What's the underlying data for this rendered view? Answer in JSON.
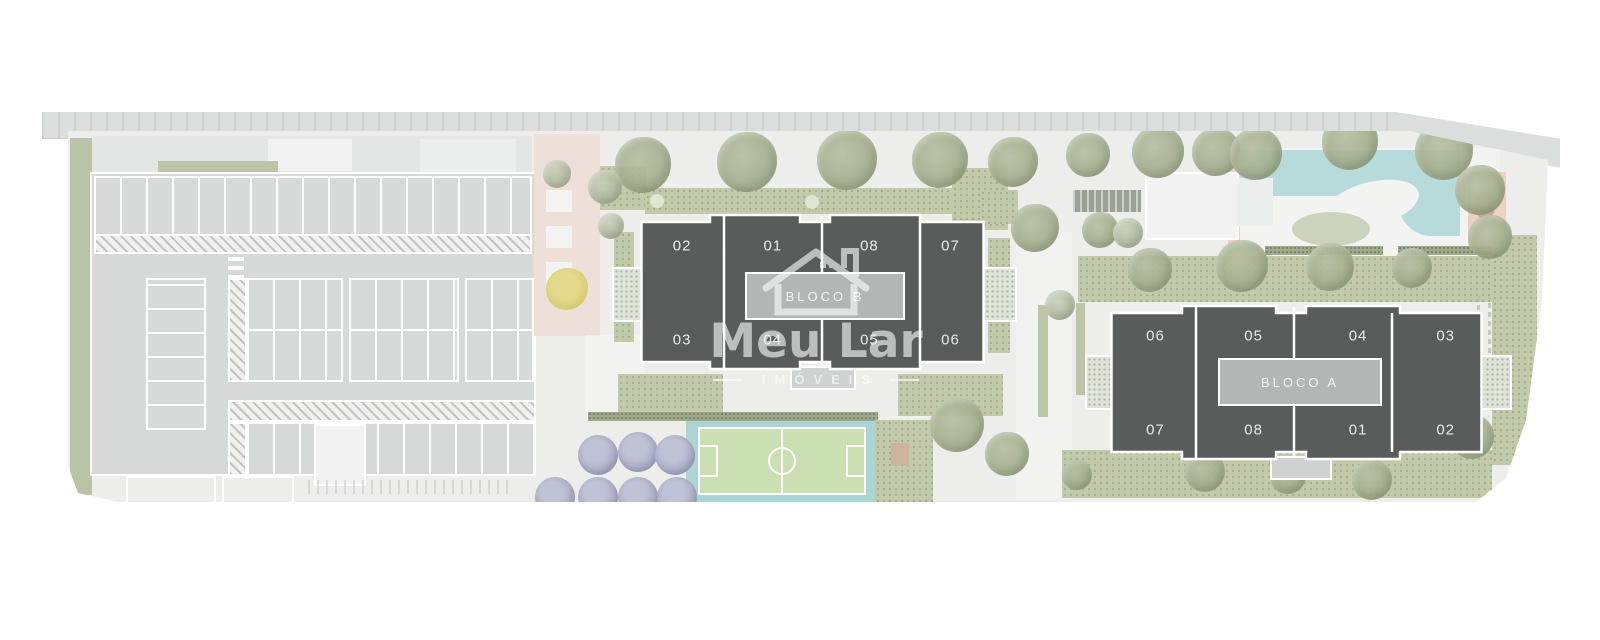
{
  "plan": {
    "watermark": {
      "brand": "Meu Lar",
      "subtitle": "IMÓVEIS"
    },
    "blocks": [
      {
        "id": "bloco-b",
        "label": "BLOCO B",
        "units_top": [
          "02",
          "01",
          "08",
          "07"
        ],
        "units_bottom": [
          "03",
          "04",
          "05",
          "06"
        ]
      },
      {
        "id": "bloco-a",
        "label": "BLOCO A",
        "units_top": [
          "06",
          "05",
          "04",
          "03"
        ],
        "units_bottom": [
          "07",
          "08",
          "01",
          "02"
        ]
      }
    ],
    "colors": {
      "unit_fill": "#595c5a",
      "corridor_fill": "#b3b6b4",
      "outline": "#ffffff",
      "ground": "#edeeeb",
      "asphalt": "#d7d9d8",
      "garden_green": "#c2caab",
      "pool_water": "#b7dbdb",
      "court_green": "#cadfb2",
      "court_deck": "#abd5d5",
      "umbrella_lavender": "#acaec6",
      "leisure_pink": "#eedfd9"
    }
  }
}
